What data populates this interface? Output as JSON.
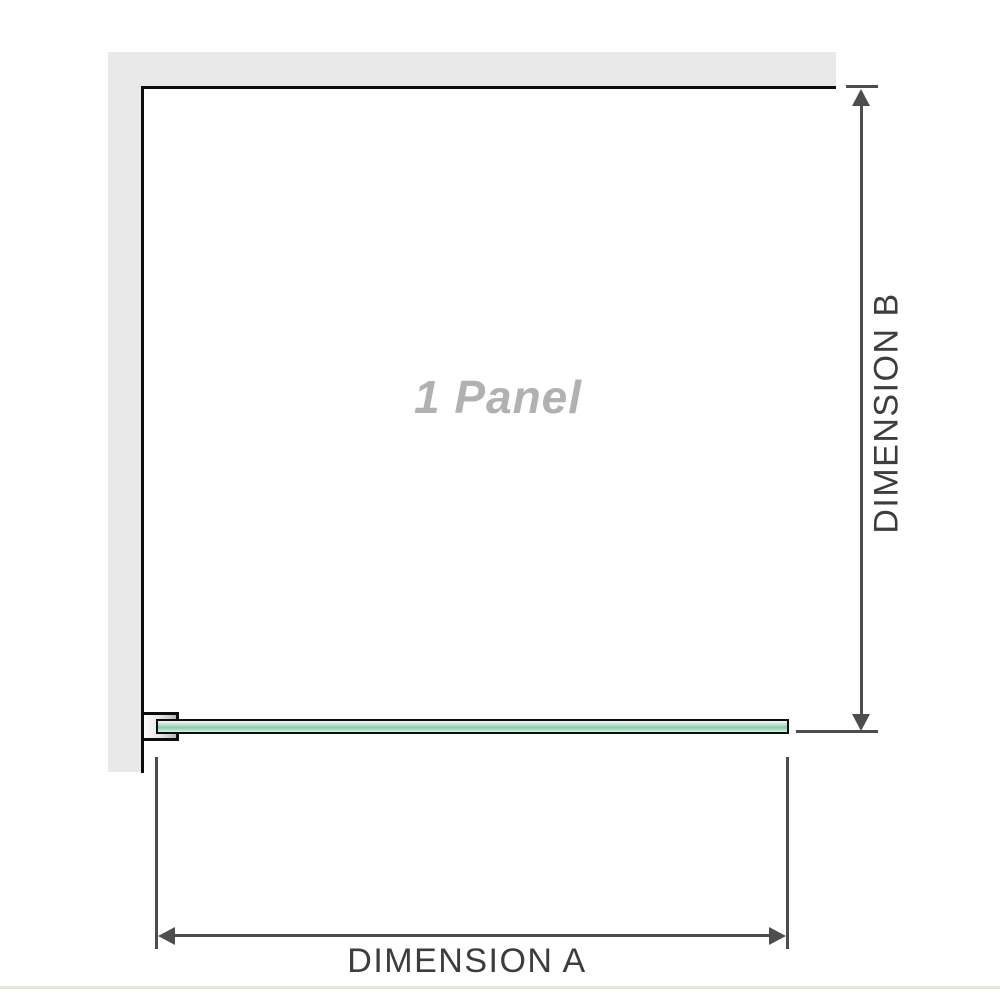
{
  "diagram": {
    "panel_label": "1 Panel",
    "dimension_a": {
      "label": "DIMENSION A",
      "orientation": "horizontal",
      "measures": "panel width"
    },
    "dimension_b": {
      "label": "DIMENSION B",
      "orientation": "vertical",
      "measures": "panel depth"
    },
    "parts": {
      "wall": "l-shaped-wall",
      "glass_panel": "single-glass-panel-plan-view",
      "bracket": "wall-mount-bracket"
    }
  },
  "icons": {
    "arrow_up": "arrow-up-icon",
    "arrow_down": "arrow-down-icon",
    "arrow_left": "arrow-left-icon",
    "arrow_right": "arrow-right-icon"
  },
  "colors": {
    "wall": "#e9e9e9",
    "outline": "#0d0d0d",
    "glass_light": "#eef8f1",
    "glass_mid": "#8bcbaa",
    "dimension_line": "#4d4d4d",
    "dimension_text": "#3d3d3d",
    "panel_label_text": "#b1b1b1",
    "bottom_rule": "#e7e4da"
  }
}
